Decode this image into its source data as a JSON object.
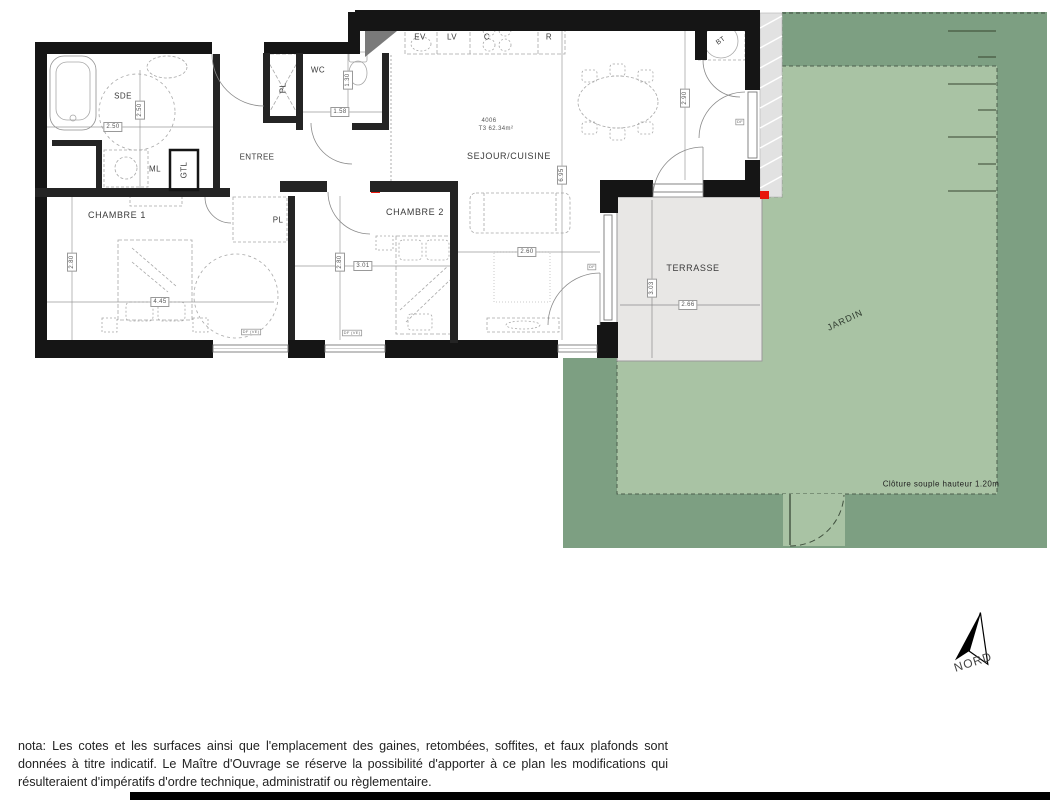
{
  "plan": {
    "apartment": {
      "number": "4006",
      "type_area": "T3 62.34m²"
    },
    "rooms": {
      "sde": "SDE",
      "wc": "WC",
      "entree": "ENTREE",
      "chambre1": "CHAMBRE 1",
      "chambre2": "CHAMBRE 2",
      "sejour": "SEJOUR/CUISINE",
      "terrasse": "TERRASSE",
      "jardin": "JARDIN"
    },
    "fixtures": {
      "ml": "ML",
      "gtl": "GTL",
      "bt": "BT",
      "pl_entree": "PL",
      "pl_chambre1": "PL"
    },
    "kitchen": {
      "ev": "EV",
      "lv": "LV",
      "c": "C",
      "r": "R"
    },
    "dimensions": {
      "sde_w": "2.50",
      "sde_h": "2.50",
      "wc_w": "1.58",
      "wc_h": "1.30",
      "sejour_right_h": "2.90",
      "sejour_h": "6.95",
      "chambre1_w": "4.45",
      "chambre1_h": "2.80",
      "chambre2_w": "3.01",
      "chambre2_h": "2.80",
      "sejour_w": "2.60",
      "terrasse_w": "2.66",
      "terrasse_h": "3.03"
    },
    "window_labels": {
      "w1": "DF (VE)",
      "w2": "DF (VE)",
      "w3": "DF",
      "w4": "DF"
    },
    "garden": {
      "cloture_note": "Clôture souple hauteur 1.20m"
    },
    "compass": {
      "north": "NORD"
    },
    "nota": "nota: Les cotes et les surfaces ainsi que l'emplacement des gaines, retombées, soffites, et faux plafonds sont données à titre indicatif. Le Maître d'Ouvrage se réserve la possibilité d'apporter à ce plan les modifications qui résulteraient d'impératifs d'ordre technique, administratif ou règlementaire.",
    "colors": {
      "wall": "#151515",
      "garden_dark": "#7d9f82",
      "garden_light": "#a9c3a4",
      "terrace": "#e8e7e5",
      "hatch_strip": "#e2e2e2",
      "accent_red": "#e8170d"
    }
  }
}
